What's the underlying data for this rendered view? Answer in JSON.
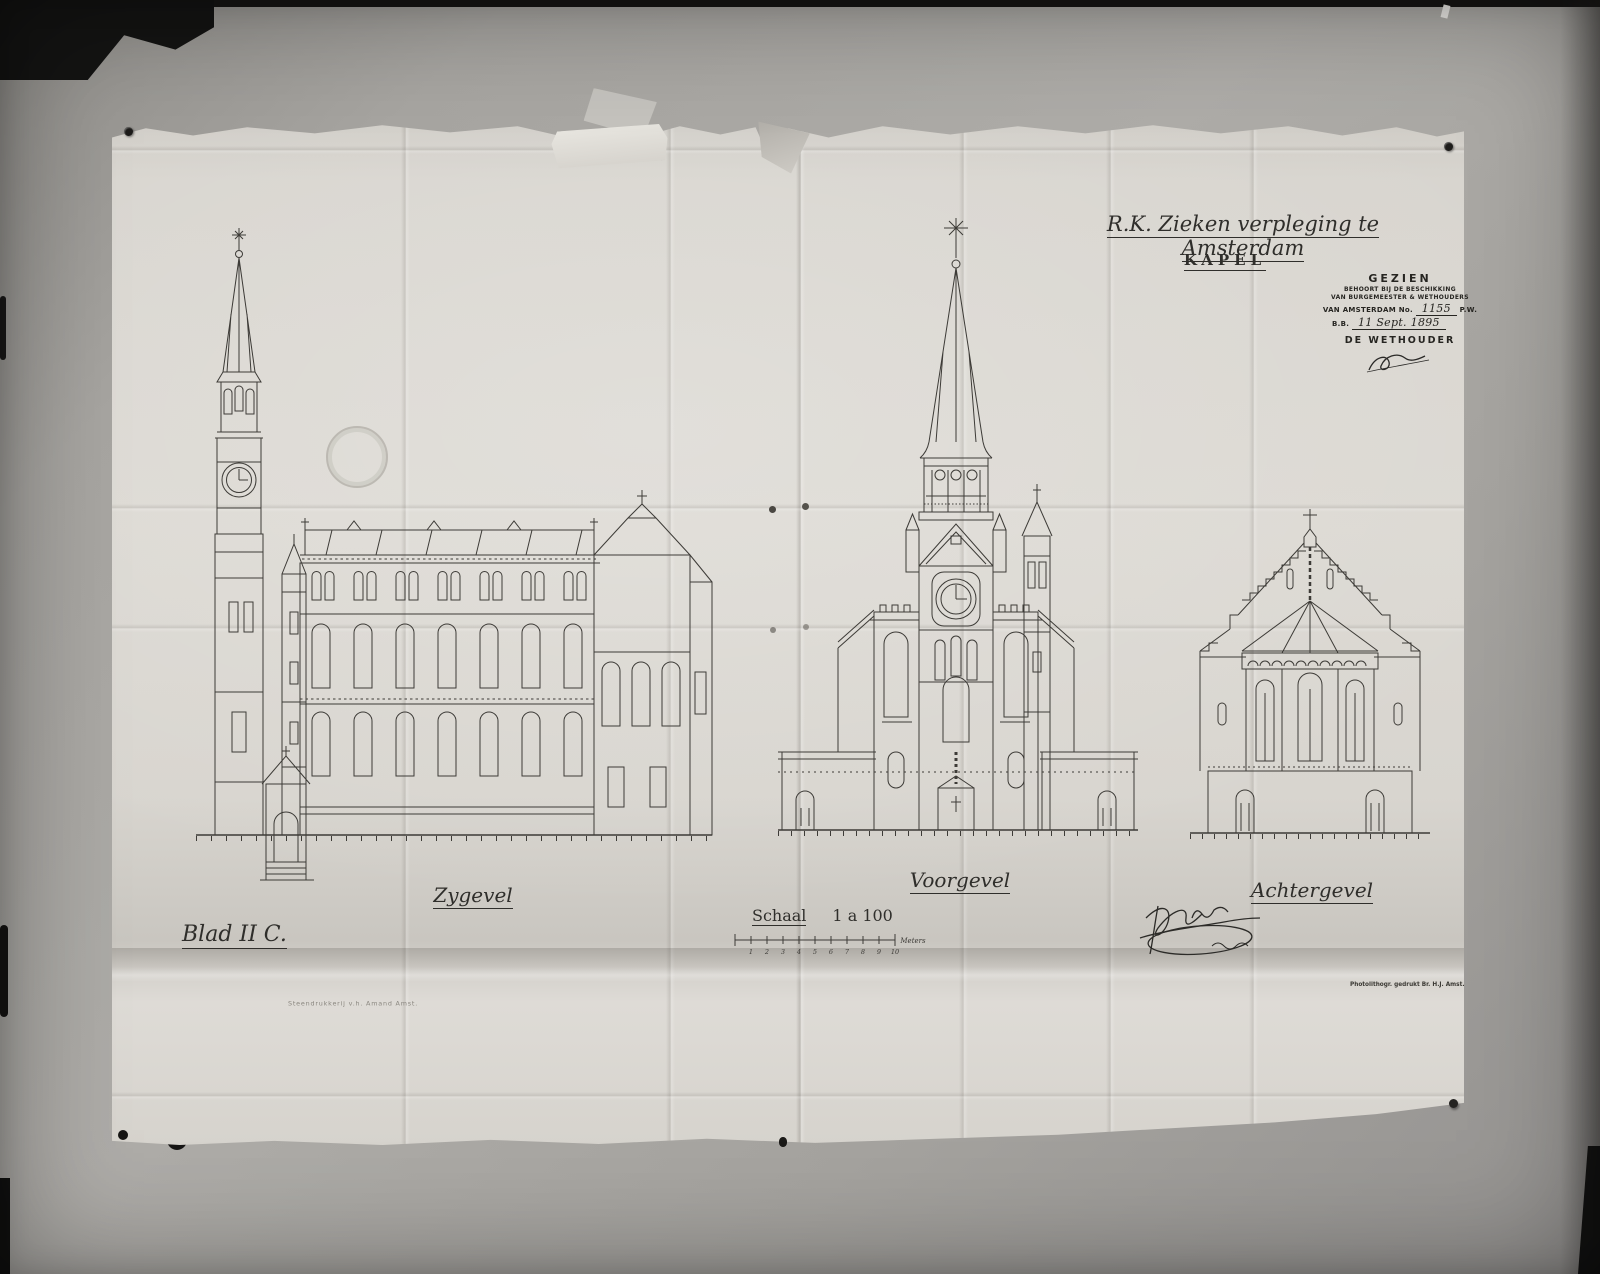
{
  "photo": {
    "wall_color": "#a7a5a1",
    "paper_color": "#dad7d1",
    "ink_color": "#33312e"
  },
  "titles": {
    "project": "R.K. Zieken verpleging te Amsterdam",
    "subtitle": "KAPEL"
  },
  "stamp": {
    "seen": "GEZIEN",
    "line2": "BEHOORT BIJ DE BESCHIKKING",
    "line3": "VAN BURGEMEESTER & WETHOUDERS",
    "line4_prefix": "VAN AMSTERDAM No.",
    "number": "1155",
    "line4_suffix": "P.W.",
    "line5_prefix": "B.B.",
    "date": "11 Sept. 1895",
    "officer": "DE WETHOUDER"
  },
  "elevations": [
    {
      "id": "zygevel",
      "label": "Zygevel"
    },
    {
      "id": "voorgevel",
      "label": "Voorgevel"
    },
    {
      "id": "achtergevel",
      "label": "Achtergevel"
    }
  ],
  "scale": {
    "label": "Schaal",
    "ratio": "1 a 100",
    "unit": "Meters",
    "ticks": [
      "1",
      "2",
      "3",
      "4",
      "5",
      "6",
      "7",
      "8",
      "9",
      "10"
    ]
  },
  "sheet_label": "Blad II C.",
  "imprints": {
    "left": "Steendrukkerij v.h. Amand Amst.",
    "right": "Photolithogr. gedrukt Br. H.J. Amst."
  }
}
